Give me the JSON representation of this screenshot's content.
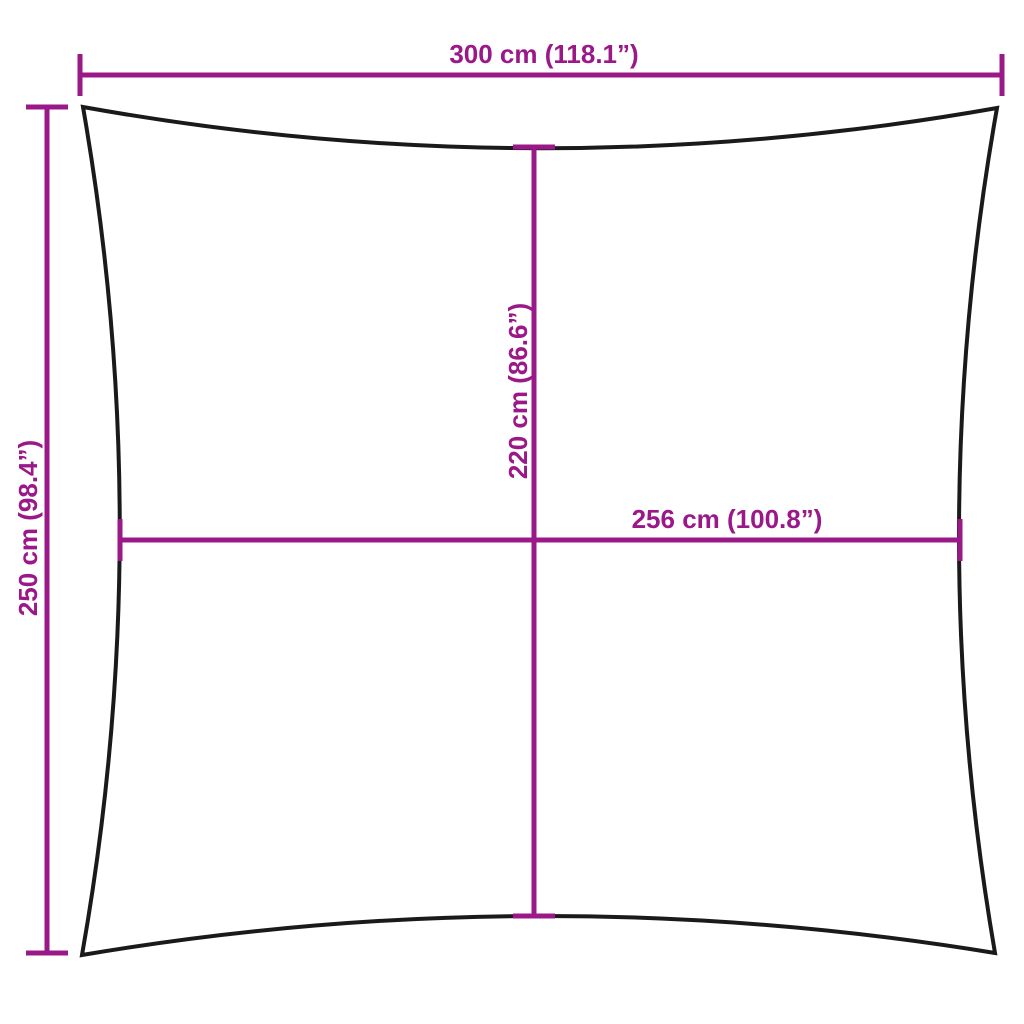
{
  "diagram": {
    "type": "shade-sail-dimension-diagram",
    "labels": {
      "outer_width": "300 cm (118.1”)",
      "outer_height": "250 cm (98.4”)",
      "inner_height": "220 cm (86.6”)",
      "inner_width": "256 cm (100.8”)"
    },
    "measurements": {
      "outer_width_cm": 300,
      "outer_width_in": 118.1,
      "outer_height_cm": 250,
      "outer_height_in": 98.4,
      "inner_height_cm": 220,
      "inner_height_in": 86.6,
      "inner_width_cm": 256,
      "inner_width_in": 100.8
    },
    "colors": {
      "dimension": "#9A1888",
      "outline": "#1A1A1A",
      "background": "#FFFFFF"
    }
  }
}
